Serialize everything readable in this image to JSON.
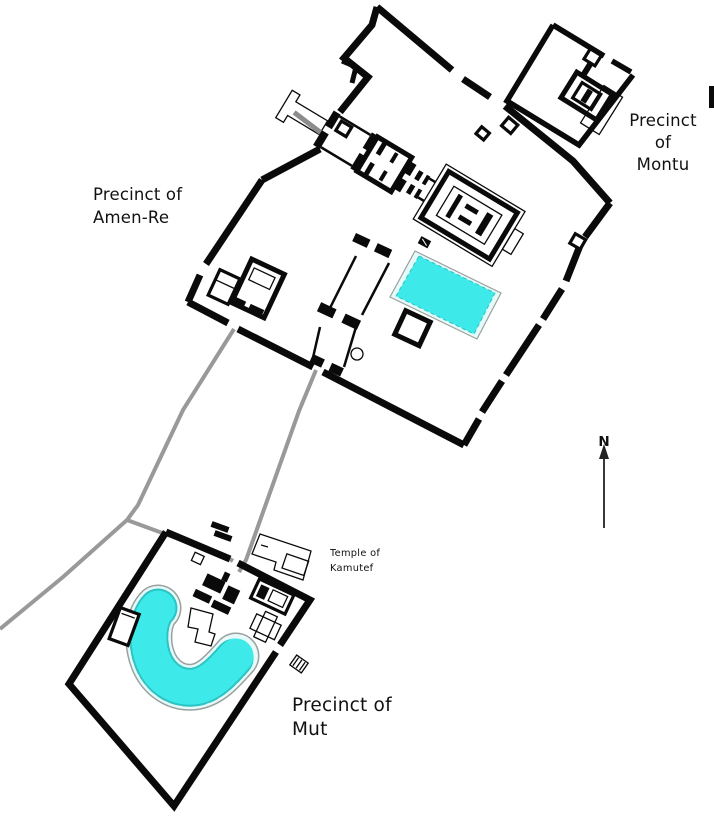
{
  "map": {
    "title": "Karnak Temple Complex site plan",
    "labels": {
      "amen_re_line1": "Precinct of",
      "amen_re_line2": "Amen-Re",
      "montu_line1": "Precinct",
      "montu_line2": "of",
      "montu_line3": "Montu",
      "mut_line1": "Precinct of",
      "mut_line2": "Mut",
      "kamutef_line1": "Temple of",
      "kamutef_line2": "Kamutef",
      "north_indicator": "N"
    },
    "features": {
      "amen_re_enclosure": "enclosure wall of the Precinct of Amen-Re",
      "montu_enclosure": "enclosure wall of the Precinct of Montu",
      "mut_enclosure": "enclosure wall of the Precinct of Mut",
      "sacred_lake": "rectangular sacred lake",
      "isheru_lake": "crescent-shaped lake",
      "kamutef_temple": "Temple of Kamutef outline",
      "avenues": "processional avenues",
      "quay_ramp": "entrance quay and ramp",
      "north_arrow": "north direction arrow"
    },
    "colors": {
      "background": "#ffffff",
      "wall": "#0a0a0a",
      "avenue": "#999999",
      "lake_fill": "#3ee9e9",
      "lake_rim": "#e6fafa",
      "lake_outline": "#9aa0a0",
      "lake_dash": "#2cc3c3",
      "text": "#111111"
    }
  }
}
